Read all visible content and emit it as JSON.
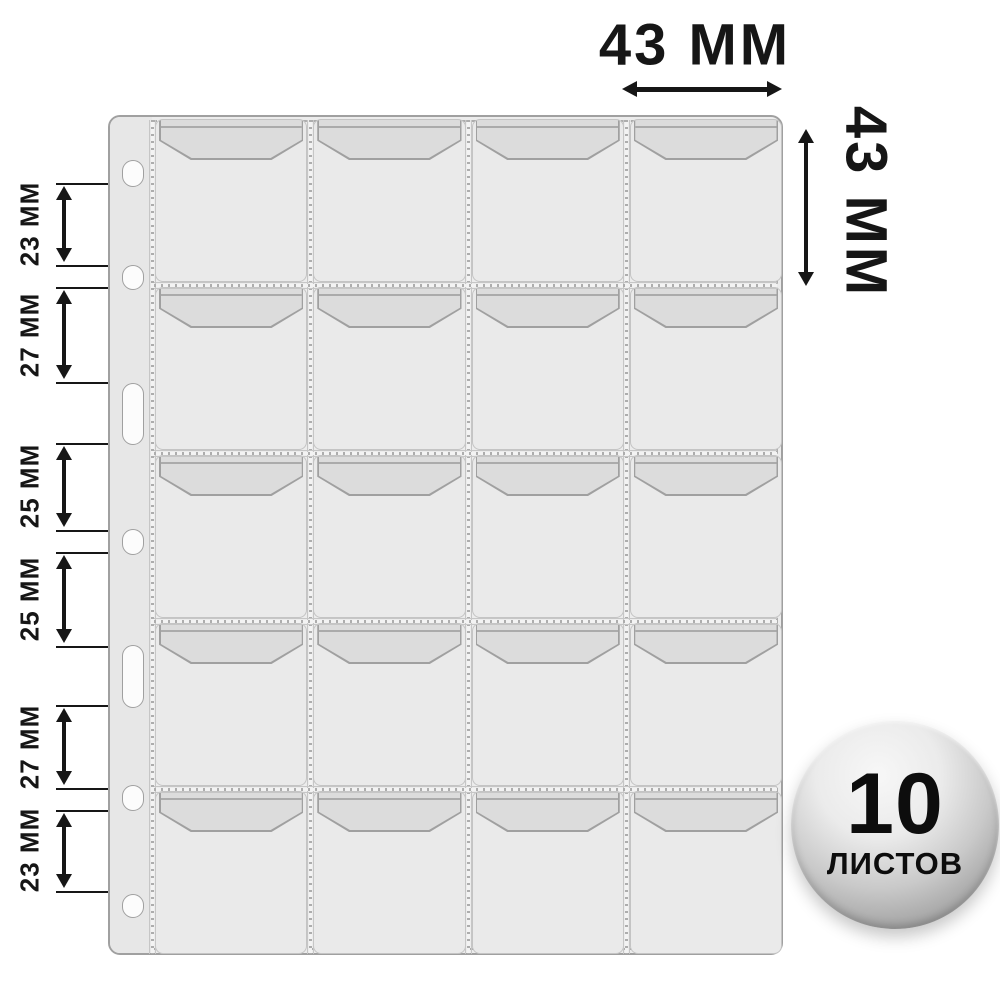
{
  "dimensions": {
    "pocket_width": {
      "label": "43 ММ"
    },
    "pocket_height": {
      "label": "43 ММ"
    },
    "left_spacings": [
      {
        "label": "23 ММ"
      },
      {
        "label": "27 ММ"
      },
      {
        "label": "25 ММ"
      },
      {
        "label": "25 ММ"
      },
      {
        "label": "27 ММ"
      },
      {
        "label": "23 ММ"
      }
    ]
  },
  "badge": {
    "count": "10",
    "unit": "ЛИСТОВ"
  },
  "sheet": {
    "rows": 5,
    "columns": 4,
    "pocket_count": 20,
    "hole_count": 7
  },
  "colors": {
    "background": "#ffffff",
    "annotation": "#161616",
    "sheet_fill": "#ececec",
    "strip_fill": "#e7e7e7",
    "pocket_fill": "#eaeaea",
    "flap_fill": "#dcdcdc",
    "outline": "#a0a0a0",
    "stitch": "#adadad",
    "badge_dark": "#8b8b8b"
  }
}
